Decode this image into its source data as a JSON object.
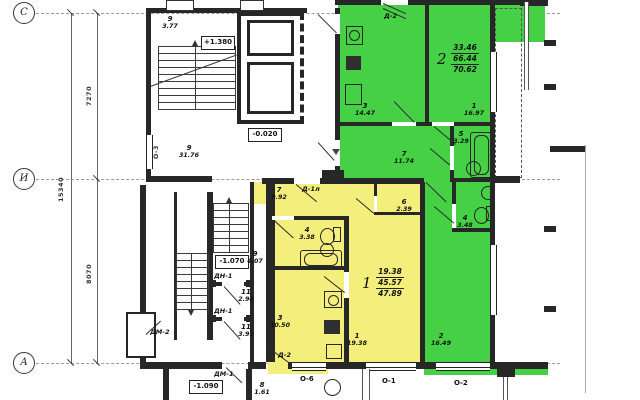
{
  "axes": {
    "c": "С",
    "i": "И",
    "a": "А",
    "dim_upper": "7270",
    "dim_total": "15340",
    "dim_lower": "8070"
  },
  "elev": {
    "upper": "+1.380",
    "floor": "-0.020",
    "lower": "-1.070",
    "porch": "-1.090"
  },
  "apt1": {
    "num": "1",
    "living": "19.38",
    "useful": "45.57",
    "total": "47.89",
    "rooms": {
      "hall": {
        "num": "7",
        "area": "9.92"
      },
      "bath": {
        "num": "4",
        "area": "3.38"
      },
      "closet": {
        "num": "6",
        "area": "2.39"
      },
      "kitchen": {
        "num": "3",
        "area": "10.50"
      },
      "room": {
        "num": "1",
        "area": "19.38"
      }
    }
  },
  "apt2": {
    "num": "2",
    "living": "33.46",
    "useful": "66.44",
    "total": "70.62",
    "rooms": {
      "kitchen": {
        "num": "3",
        "area": "14.47"
      },
      "room1": {
        "num": "1",
        "area": "16.97"
      },
      "hall": {
        "num": "7",
        "area": "11.74"
      },
      "bath": {
        "num": "5",
        "area": "3.29"
      },
      "wc": {
        "num": "4",
        "area": "3.48"
      },
      "room2": {
        "num": "2",
        "area": "16.49"
      }
    }
  },
  "common": {
    "stair_up": {
      "num": "9",
      "area": "3.77"
    },
    "corridor": {
      "num": "9",
      "area": "31.76"
    },
    "stair_low": {
      "num": "9",
      "area": "4.07"
    },
    "tambour_a": {
      "num": "11",
      "area": "2.94"
    },
    "tambour_b": {
      "num": "11",
      "area": "3.91"
    },
    "porch8": {
      "num": "8",
      "area": "1.61"
    }
  },
  "doors": {
    "d2_balcony": "Д-2",
    "d1l": "Д-1л",
    "d2_exit": "Д-2",
    "dn1_a": "ДН-1",
    "dn1_b": "ДН-1",
    "dm1": "ДМ-1",
    "dm2": "ДМ-2"
  },
  "windows": {
    "o3": "О-3",
    "o6": "О-6",
    "o1": "О-1",
    "o2": "О-2"
  },
  "colors": {
    "apartment_1": "#f4ee7c",
    "apartment_2": "#45d045",
    "walls": "#272727"
  }
}
